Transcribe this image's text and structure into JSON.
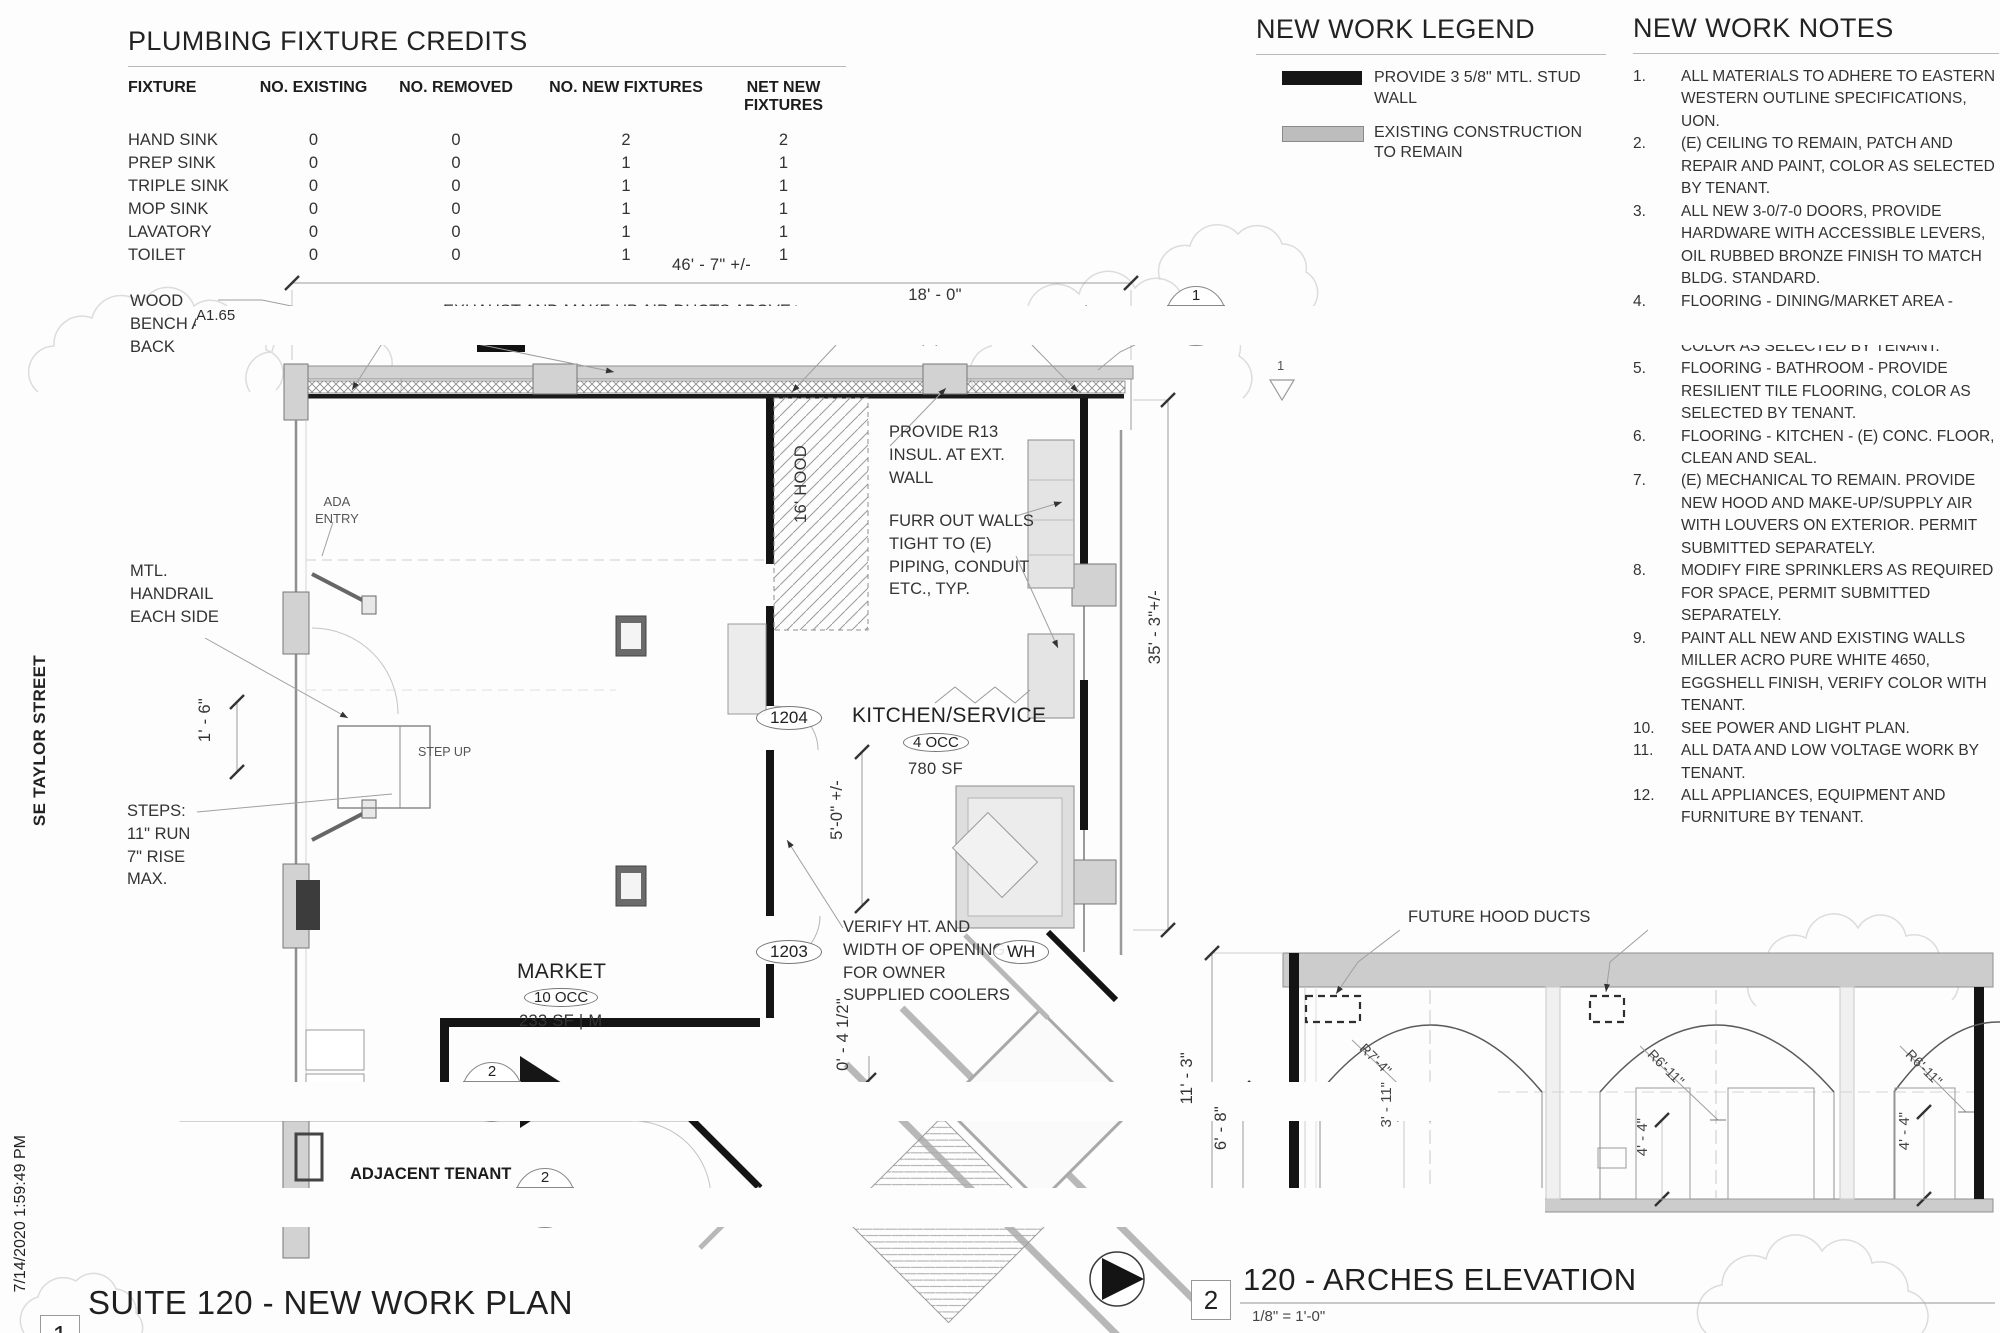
{
  "sheet": {
    "timestamp": "7/14/2020 1:59:49 PM",
    "street": "SE TAYLOR STREET"
  },
  "fixture_table": {
    "title": "PLUMBING FIXTURE CREDITS",
    "columns": [
      "FIXTURE",
      "NO. EXISTING",
      "NO. REMOVED",
      "NO. NEW FIXTURES",
      "NET NEW FIXTURES"
    ],
    "rows": [
      [
        "HAND SINK",
        "0",
        "0",
        "2",
        "2"
      ],
      [
        "PREP SINK",
        "0",
        "0",
        "1",
        "1"
      ],
      [
        "TRIPLE SINK",
        "0",
        "0",
        "1",
        "1"
      ],
      [
        "MOP SINK",
        "0",
        "0",
        "1",
        "1"
      ],
      [
        "LAVATORY",
        "0",
        "0",
        "1",
        "1"
      ],
      [
        "TOILET",
        "0",
        "0",
        "1",
        "1"
      ]
    ]
  },
  "legend": {
    "title": "NEW WORK LEGEND",
    "colors": {
      "new_wall": "#161616",
      "existing": "#bdbdbd"
    },
    "items": [
      {
        "name": "new-stud-wall-swatch",
        "label": "PROVIDE 3 5/8\" MTL. STUD WALL"
      },
      {
        "name": "existing-construction-swatch",
        "label": "EXISTING CONSTRUCTION TO REMAIN"
      }
    ]
  },
  "notes": {
    "title": "NEW WORK NOTES",
    "items": [
      {
        "num": "1.",
        "text": "ALL MATERIALS TO ADHERE TO EASTERN WESTERN OUTLINE SPECIFICATIONS, UON."
      },
      {
        "num": "2.",
        "text": "(E) CEILING TO REMAIN, PATCH AND REPAIR AND PAINT, COLOR AS SELECTED BY TENANT."
      },
      {
        "num": "3.",
        "text": "ALL NEW 3-0/7-0 DOORS, PROVIDE HARDWARE WITH ACCESSIBLE LEVERS, OIL RUBBED BRONZE FINISH TO MATCH BLDG. STANDARD."
      },
      {
        "num": "4.",
        "text": "FLOORING - DINING/MARKET AREA - PROVIDE RESILIENT TILE FLOORING, COLOR AS SELECTED BY TENANT."
      },
      {
        "num": "5.",
        "text": "FLOORING - BATHROOM - PROVIDE RESILIENT TILE FLOORING, COLOR AS SELECTED BY TENANT."
      },
      {
        "num": "6.",
        "text": "FLOORING - KITCHEN - (E) CONC. FLOOR, CLEAN AND SEAL."
      },
      {
        "num": "7.",
        "text": "(E) MECHANICAL TO REMAIN. PROVIDE NEW HOOD AND MAKE-UP/SUPPLY AIR WITH LOUVERS ON EXTERIOR. PERMIT SUBMITTED SEPARATELY."
      },
      {
        "num": "8.",
        "text": "MODIFY FIRE SPRINKLERS AS REQUIRED FOR SPACE, PERMIT SUBMITTED SEPARATELY."
      },
      {
        "num": "9.",
        "text": "PAINT ALL NEW AND EXISTING WALLS MILLER ACRO PURE WHITE 4650, EGGSHELL FINISH, VERIFY COLOR WITH TENANT."
      },
      {
        "num": "10.",
        "text": "SEE POWER AND LIGHT PLAN."
      },
      {
        "num": "11.",
        "text": "ALL DATA AND LOW VOLTAGE WORK BY TENANT."
      },
      {
        "num": "12.",
        "text": "ALL APPLIANCES, EQUIPMENT AND FURNITURE BY TENANT."
      }
    ]
  },
  "plan": {
    "title_num": "1",
    "title": "SUITE 120 - NEW WORK PLAN",
    "scale": "1/8\" = 1'-0\"",
    "dims": {
      "overall_width": "46' - 7\" +/-",
      "kitchen_width": "18' - 0\"",
      "depth": "35' - 3\"+/-",
      "cooler_opening": "5'-0\" +/-",
      "wall_offset": "0' - 4 1/2\"",
      "bench_depth": "1' - 6\""
    },
    "labels": {
      "wood_bench": "WOOD\nBENCH AND\nBACK",
      "exhaust": "EXHAUST AND MAKE UP AIR DUCTS ABOVE\nFOR NEW HOOD, PER MECH.",
      "align_columns": "ALIGN WITH (E) COLUMNS",
      "provide_r13": "PROVIDE R13\nINSUL. AT EXT.\nWALL",
      "furr_out": "FURR OUT WALLS\nTIGHT TO (E)\nPIPING, CONDUIT\nETC., TYP.",
      "hood": "16' HOOD",
      "ada_entry": "ADA\nENTRY",
      "handrail": "MTL.\nHANDRAIL\nEACH SIDE",
      "step_up": "STEP UP",
      "steps": "STEPS:\n11\" RUN\n7\" RISE\nMAX.",
      "verify": "VERIFY HT. AND\nWIDTH OF OPENING\nFOR OWNER\nSUPPLIED COOLERS",
      "adjacent_tenant": "ADJACENT TENANT\nROOKS",
      "wh": "WH"
    },
    "rooms": {
      "kitchen": {
        "name": "KITCHEN/SERVICE",
        "occ": "4 OCC",
        "area": "780 SF",
        "tag": "1204"
      },
      "market": {
        "name": "MARKET",
        "occ": "10 OCC",
        "area": "233 SF | M",
        "tag": "1203"
      }
    },
    "callouts": {
      "c1": {
        "num": "1",
        "sheet": "A1.65"
      },
      "c2": {
        "num": "2",
        "sheet": "A1.55"
      },
      "c3": {
        "num": "2",
        "sheet": "A1.65"
      },
      "tri": "1"
    }
  },
  "elevation": {
    "title_num": "2",
    "title": "120 - ARCHES ELEVATION",
    "scale": "1/8\" = 1'-0\"",
    "labels": {
      "future_hood": "FUTURE HOOD DUCTS"
    },
    "dims": {
      "height": "11' - 3\"",
      "spring": "6' - 8\"",
      "r1": "R7'-4\"",
      "c1": "3' - 11\"",
      "r2": "R6'-11\"",
      "c2": "4' - 4\"",
      "r3": "R6'-11\"",
      "c3": "4' - 4\""
    }
  }
}
